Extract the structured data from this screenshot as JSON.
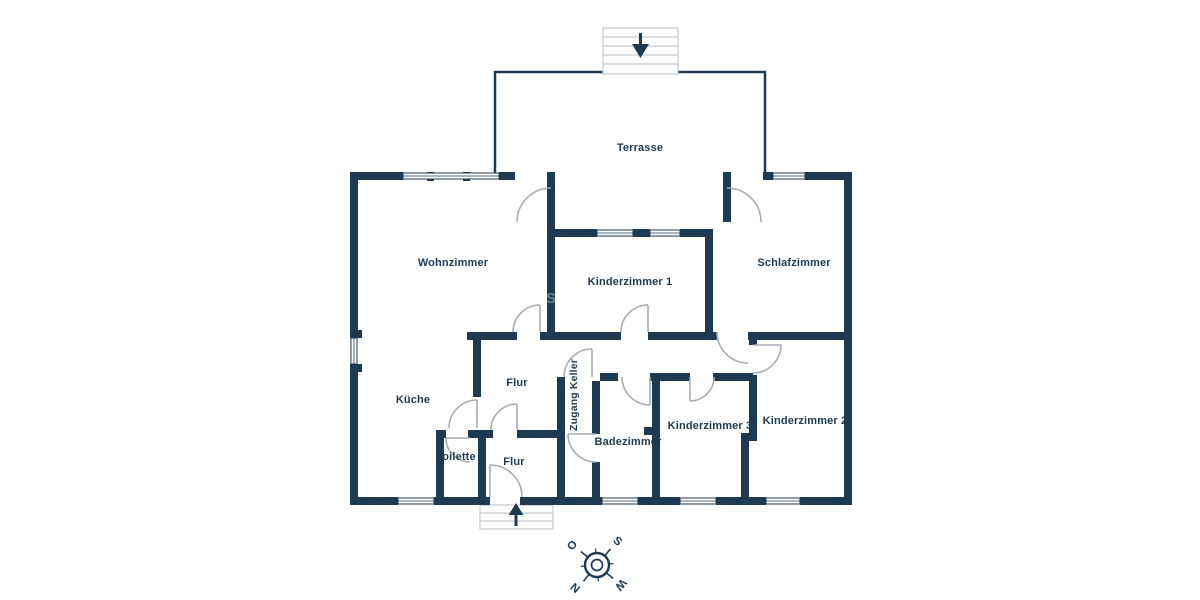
{
  "rooms": [
    {
      "id": "terrasse",
      "label": "Terrasse"
    },
    {
      "id": "wohnzimmer",
      "label": "Wohnzimmer"
    },
    {
      "id": "kinderzimmer1",
      "label": "Kinderzimmer 1"
    },
    {
      "id": "schlafzimmer",
      "label": "Schlafzimmer"
    },
    {
      "id": "kueche",
      "label": "Küche"
    },
    {
      "id": "flur_oben",
      "label": "Flur"
    },
    {
      "id": "zugang_keller",
      "label": "Zugang Keller"
    },
    {
      "id": "badezimmer",
      "label": "Badezimmer"
    },
    {
      "id": "kinderzimmer3",
      "label": "Kinderzimmer 3"
    },
    {
      "id": "kinderzimmer2",
      "label": "Kinderzimmer 2"
    },
    {
      "id": "toilette",
      "label": "Toilette"
    },
    {
      "id": "flur_unten",
      "label": "Flur"
    }
  ],
  "compass": {
    "points": [
      {
        "dir": "south",
        "label": "S"
      },
      {
        "dir": "east",
        "label": "O"
      },
      {
        "dir": "west",
        "label": "W"
      },
      {
        "dir": "north",
        "label": "N"
      }
    ]
  },
  "stairs": {
    "top": {
      "direction": "down",
      "icon": "down-arrow-icon"
    },
    "bottom": {
      "direction": "up",
      "icon": "up-arrow-icon"
    }
  },
  "watermark": {
    "label": "S"
  },
  "colors": {
    "wall": "#1E3A52",
    "door_arc": "#A6ADB5",
    "stair_outline": "#C4C9CE",
    "text": "#1E3A52",
    "background": "#FFFFFF"
  }
}
